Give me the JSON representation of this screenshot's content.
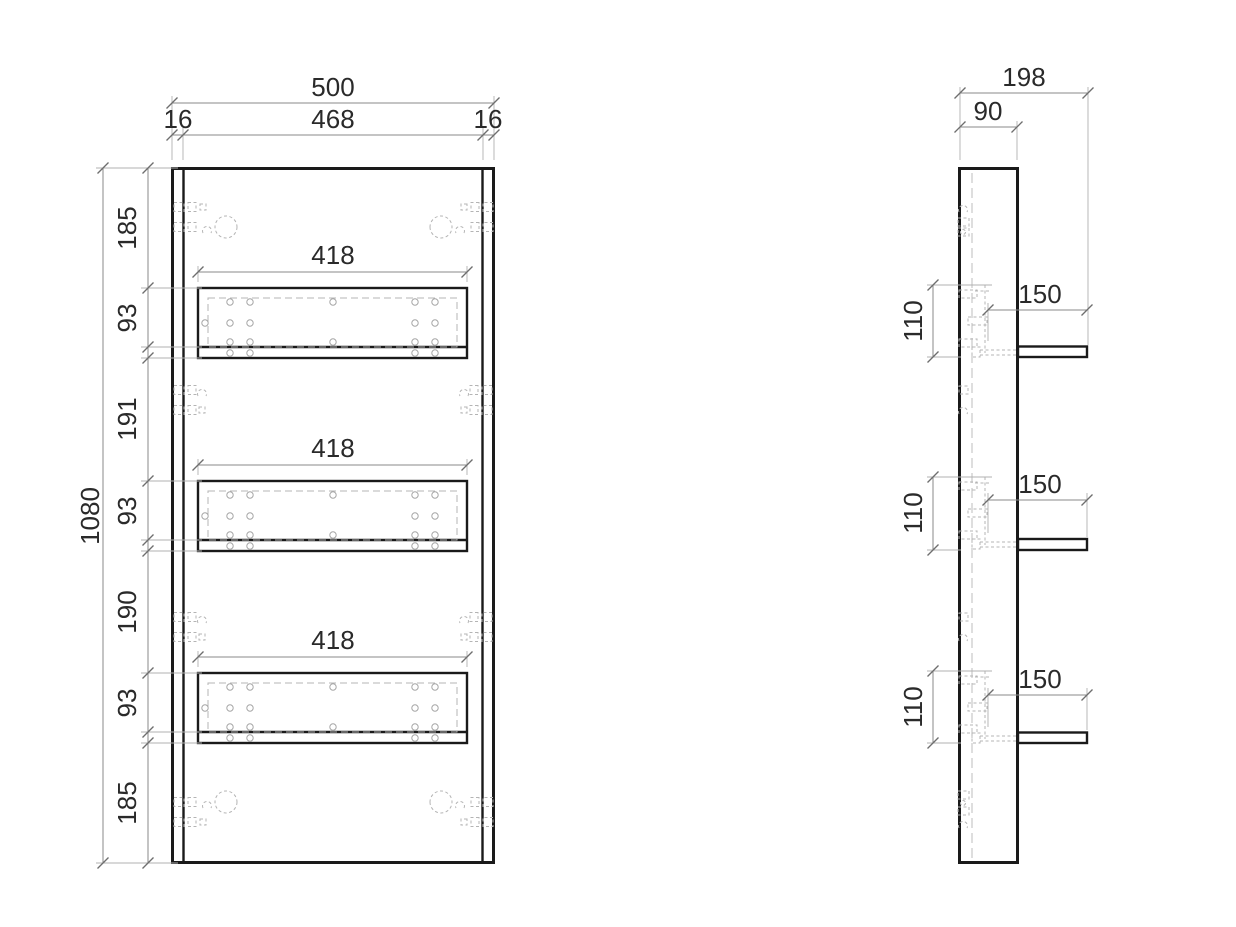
{
  "drawing": {
    "colors": {
      "background": "#ffffff",
      "outline": "#1a1a1a",
      "dimension_lines": "#8a8a8a",
      "hidden_lines": "#b4b4b4",
      "text": "#2a2a2a"
    },
    "front": {
      "width_total": "500",
      "width_inner": "468",
      "edge_left": "16",
      "edge_right": "16",
      "height_total": "1080",
      "v_chain": [
        "185",
        "93",
        "191",
        "93",
        "190",
        "93",
        "185"
      ],
      "shelf_widths": [
        "418",
        "418",
        "418"
      ]
    },
    "side": {
      "depth_total": "198",
      "panel_thickness": "90",
      "shelf_depths": [
        "150",
        "150",
        "150"
      ],
      "shelf_spacings": [
        "110",
        "110",
        "110"
      ]
    }
  }
}
